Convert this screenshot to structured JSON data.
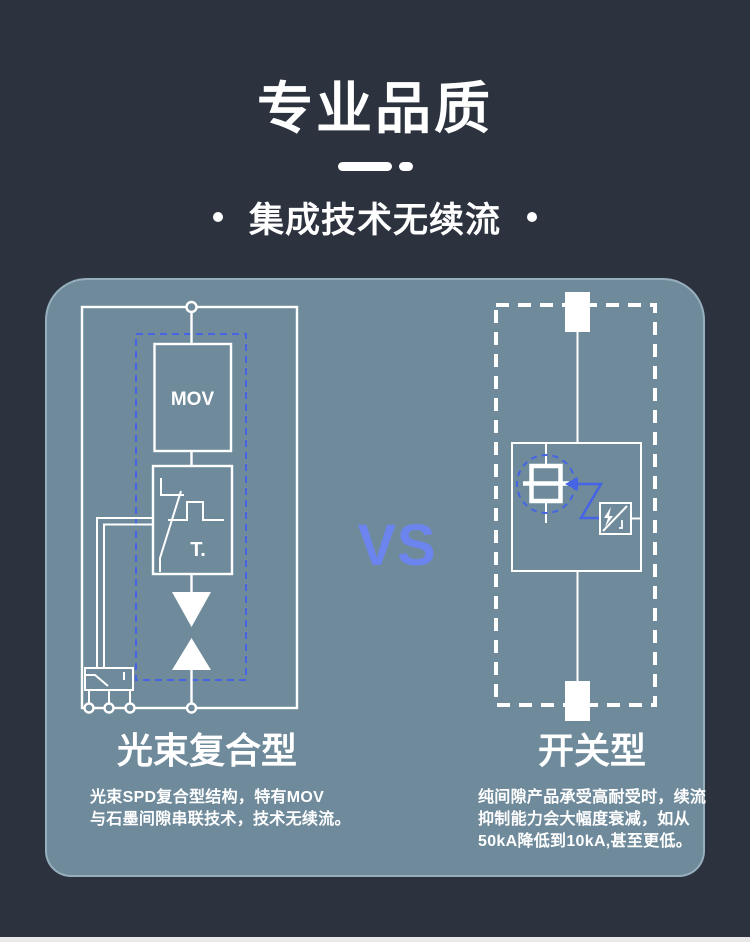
{
  "header": {
    "title": "专业品质",
    "subtitle": "集成技术无续流"
  },
  "versus": "VS",
  "comparison": {
    "left": {
      "name": "光束复合型",
      "mov_label": "MOV",
      "t_label": "T.",
      "desc": {
        "line1": "光束SPD复合型结构，特有MOV",
        "line2": "与石墨间隙串联技术，技术无续流。"
      }
    },
    "right": {
      "name": "开关型",
      "desc": {
        "line1": "纯间隙产品承受高耐受时，续流",
        "line2": "抑制能力会大幅度衰减，如从",
        "line3": "50kA降低到10kA,甚至更低。"
      }
    }
  },
  "icons": {
    "divider": "rounded-dash-and-dot",
    "subtitle_bullets": "round-dot",
    "left_diagram": [
      "mov-varistor-box",
      "thermal-disconnector-box",
      "spark-gap-triangles",
      "terminal-circles",
      "switch-box"
    ],
    "right_diagram": [
      "top-terminal-block",
      "gas-discharge-tube",
      "lightning-trigger-box",
      "blue-arrow",
      "bottom-terminal-block"
    ]
  },
  "colors": {
    "background": "#2c323e",
    "panel": "#6e8a9b",
    "line_white": "#ffffff",
    "accent_blue": "#4564e6",
    "vs_blue": "#6c85ee",
    "bottom_strip": "#e9e9e9"
  }
}
